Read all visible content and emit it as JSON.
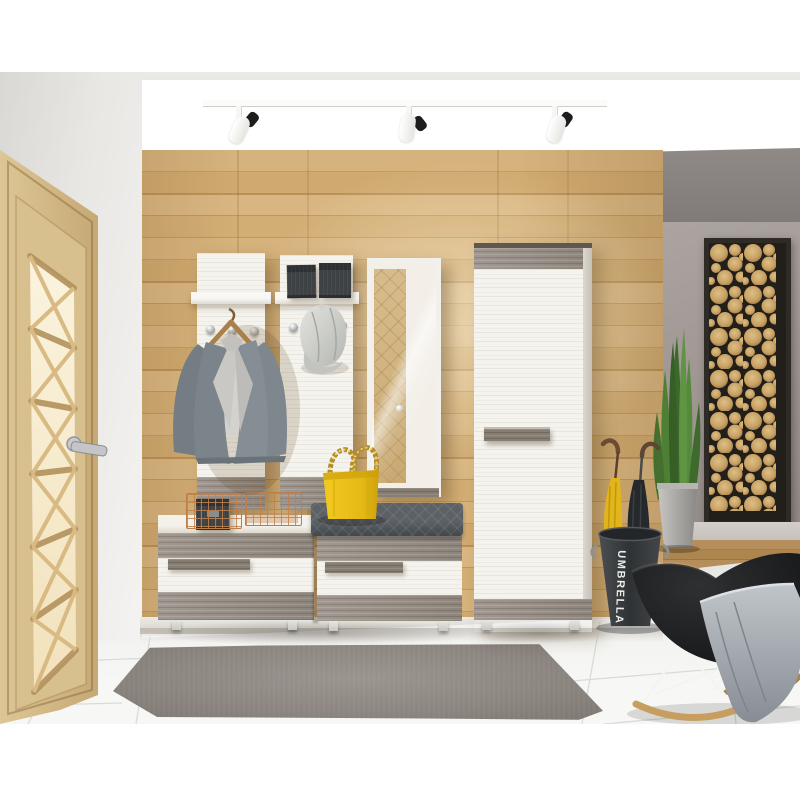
{
  "scene": {
    "setting": "3D rendered hallway interior with a modern entryway furniture set",
    "umbrella_stand": {
      "label": "UMBRELLA"
    },
    "objects": [
      "ceiling track with three white spotlights",
      "oak entry door with lattice glass and chrome handle",
      "horizontal oak plank accent wall",
      "white coat panel with shelf, chrome hooks, wooden hanger and gray blazer",
      "white shelf panel with two dark storage boxes and light gray cap on hook",
      "mirror panel reflecting the door",
      "tall white wardrobe cabinet with gray driftwood trim and bar handle",
      "two-drawer shoe bench with white fronts and driftwood trim",
      "dark gray quilted bench cushion",
      "yellow chain-strap handbag",
      "two copper wire baskets, one holding a black box",
      "dark umbrella bucket with yellow and black umbrellas",
      "snake plant in a gray tapered pot",
      "tall framed wall art of wood log slices",
      "gray accent wall section with wood floor strip",
      "black rocking chair with gray throw blanket and wooden runners",
      "gray shaggy rug on glossy white tile floor"
    ],
    "palette": {
      "wood_wall": "#cda76e",
      "white_furniture": "#f4f3ee",
      "driftwood_trim": "#968d84",
      "cushion_gray": "#53585c",
      "handbag_yellow": "#ecc31e",
      "copper_basket": "#bb7f49",
      "accent_wall": "#a29a96",
      "log_slice": "#c9a164",
      "plant_green": "#4f8438",
      "chair_black": "#1d1f21",
      "rug_gray": "#8d8680",
      "tile_floor": "#f2f2f0",
      "door_oak": "#d5bc8a"
    }
  }
}
